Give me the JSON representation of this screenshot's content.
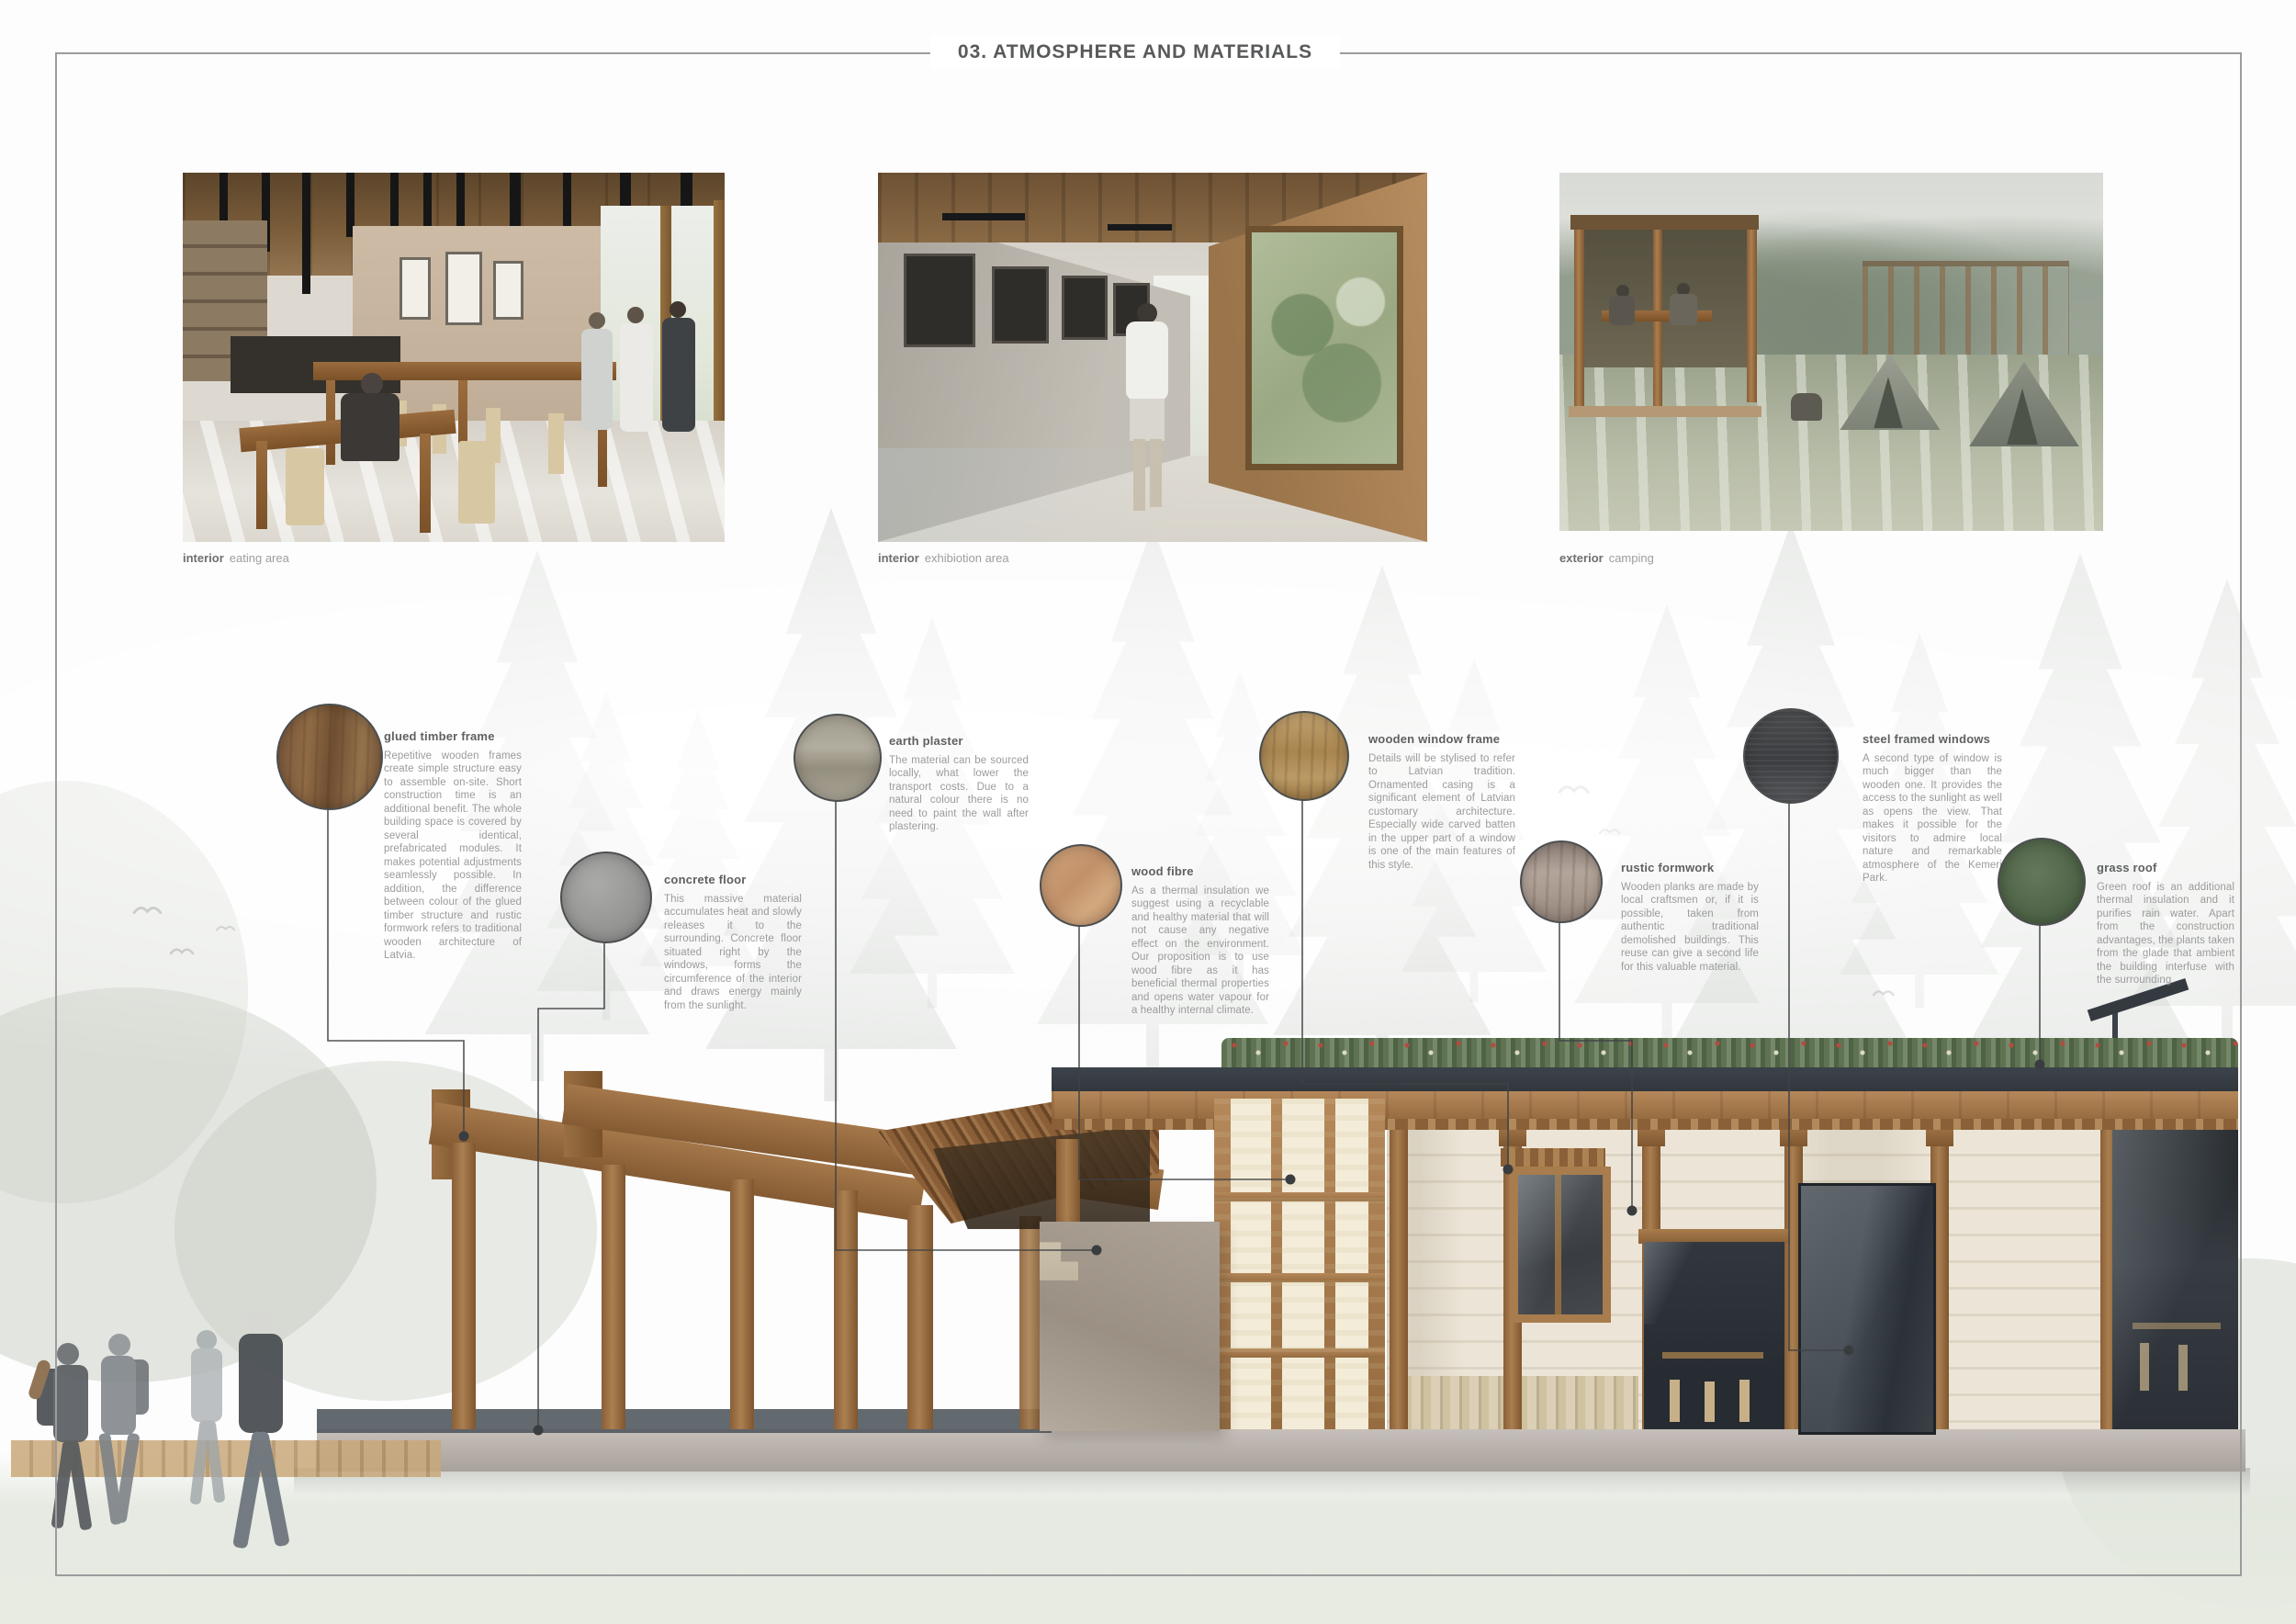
{
  "title": "03. ATMOSPHERE AND MATERIALS",
  "photos": [
    {
      "label_bold": "interior",
      "label_rest": "eating area"
    },
    {
      "label_bold": "interior",
      "label_rest": "exhibiotion area"
    },
    {
      "label_bold": "exterior",
      "label_rest": "camping"
    }
  ],
  "materials": [
    {
      "name": "glued timber frame",
      "swatch": "#82603f",
      "description": "Repetitive wooden frames create simple structure easy to assemble on-site. Short construction time is an additional benefit. The whole building space is covered by several identical, prefabricated modules. It makes potential adjustments seamlessly possible. In addition, the difference between colour of the glued timber structure and rustic formwork refers to traditional wooden architecture of Latvia."
    },
    {
      "name": "concrete floor",
      "swatch": "#9a9a98",
      "description": "This massive material accumulates heat and slowly releases it to the surrounding. Concrete floor situated right by the windows, forms the circumference of the interior and draws energy mainly from the sunlight."
    },
    {
      "name": "earth plaster",
      "swatch": "#a8a295",
      "description": "The material can be sourced locally, what lower the transport costs. Due to a natural colour there is no need to paint the wall after plastering."
    },
    {
      "name": "wood fibre",
      "swatch": "#c89b72",
      "description": "As a thermal insulation we suggest using a recyclable and healthy material that will not cause any negative effect on the environment. Our proposition is to use wood fibre as it has beneficial thermal properties and opens water vapour for a healthy internal climate."
    },
    {
      "name": "wooden window frame",
      "swatch": "#b2905c",
      "description": "Details will be stylised to refer to Latvian tradition. Ornamented casing is a significant element of Latvian customary architecture. Especially wide carved batten in the upper part of a window is one of the main features of this style."
    },
    {
      "name": "rustic formwork",
      "swatch": "#a5948b",
      "description": "Wooden planks are made by local craftsmen or, if it is possible, taken from authentic traditional demolished buildings. This reuse can give a second life for this valuable material."
    },
    {
      "name": "steel framed windows",
      "swatch": "#46484b",
      "description": "A second type of window is much bigger than the wooden one. It provides the access to the sunlight as well as opens the view. That makes it possible for the visitors to admire local nature and remarkable atmosphere of the Kemeri Park."
    },
    {
      "name": "grass roof",
      "swatch": "#556a4d",
      "description": "Green roof is an additional thermal insulation and it purifies rain water. Apart from the construction advantages, the plants taken from the glade that ambient the building interfuse with the surrounding."
    }
  ],
  "colors": {
    "frame_line": "#9b9c9d",
    "title_text": "#58595b",
    "body_text": "#9b9b9c",
    "leader_line": "#3f4245",
    "timber": "#9c6f46",
    "charcoal_roof": "#3d434a",
    "grass": "#5f7352",
    "whitewash_wall": "#ece5d7",
    "earth_plaster_panel": "#a79c90"
  }
}
